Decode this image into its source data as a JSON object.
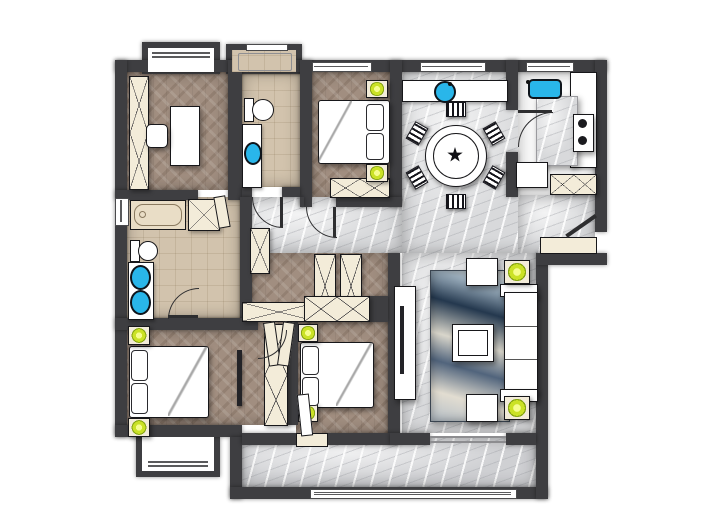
{
  "image_type": "architectural floor plan, top-down colour render, no text labels",
  "palette": {
    "wall": "#3e3e41",
    "wood": "#a18e80",
    "marble": "#d8d9db",
    "marble_dark": "#cfd0d3",
    "tile": "#d2c3ad",
    "cream": "#f3ecd9",
    "white": "#ffffff",
    "outline": "#17171a",
    "lamp_green": "#cbe226",
    "sink_blue": "#29b6ea"
  },
  "rooms": [
    {
      "name": "study",
      "floor": "herringbone-wood",
      "furniture": [
        "wall-wardrobe",
        "desk",
        "chair"
      ],
      "features": [
        "bay-window"
      ]
    },
    {
      "name": "bathroom-top",
      "floor": "beige-tile",
      "furniture": [
        "shower",
        "toilet",
        "vanity-with-sink"
      ],
      "features": [
        "small-window"
      ]
    },
    {
      "name": "bedroom-top",
      "floor": "herringbone-wood",
      "furniture": [
        "double-bed",
        "nightstand-lamp",
        "nightstand-lamp",
        "wardrobe"
      ],
      "features": [
        "window"
      ]
    },
    {
      "name": "dining-room",
      "floor": "grey-marble",
      "furniture": [
        "round-dining-table",
        "six-chairs",
        "sideboard-with-round-sink"
      ],
      "features": [
        "windows"
      ]
    },
    {
      "name": "kitchen",
      "floor": "white",
      "furniture": [
        "blue-sink",
        "marble-island",
        "two-burner-cooktop",
        "cabinet",
        "x-cabinet"
      ],
      "features": [
        "window"
      ]
    },
    {
      "name": "entry",
      "floor": "grey-marble",
      "furniture": [
        "doormat",
        "shoe-cabinet"
      ],
      "features": [
        "entry-door",
        "stoop-wall"
      ]
    },
    {
      "name": "bathroom-left",
      "floor": "beige-tile",
      "furniture": [
        "bathtub",
        "storage-cabinet",
        "toilet",
        "double-vanity-two-sinks"
      ],
      "features": [
        "side-window"
      ]
    },
    {
      "name": "inner-hall",
      "floor": "herringbone-wood",
      "furniture": [
        "x-wardrobe",
        "x-wardrobe",
        "x-wardrobe",
        "x-wardrobe",
        "door-leaves"
      ]
    },
    {
      "name": "bedroom-left",
      "floor": "herringbone-wood",
      "furniture": [
        "double-bed",
        "nightstand-lamp",
        "nightstand-lamp",
        "wall-tv",
        "wardrobe"
      ],
      "features": [
        "bay-window"
      ]
    },
    {
      "name": "bedroom-middle",
      "floor": "herringbone-wood",
      "furniture": [
        "double-bed",
        "nightstand-lamp",
        "nightstand-lamp",
        "closet-row"
      ],
      "features": [
        "balcony-door"
      ]
    },
    {
      "name": "living-room",
      "floor": "grey-marble",
      "furniture": [
        "tv-console",
        "tv",
        "blue-marbled-rug",
        "coffee-table",
        "armchair",
        "armchair",
        "lamp-side-table",
        "lamp-side-table",
        "three-seat-sofa"
      ],
      "features": [
        "sliding-opening-to-balcony"
      ]
    },
    {
      "name": "balcony",
      "floor": "grey-marble",
      "features": [
        "long-bottom-window"
      ]
    }
  ],
  "counts": {
    "bedrooms": 3,
    "bathrooms": 2,
    "green-lamps": 8,
    "blue-sinks": 5,
    "dining-chairs": 6
  }
}
